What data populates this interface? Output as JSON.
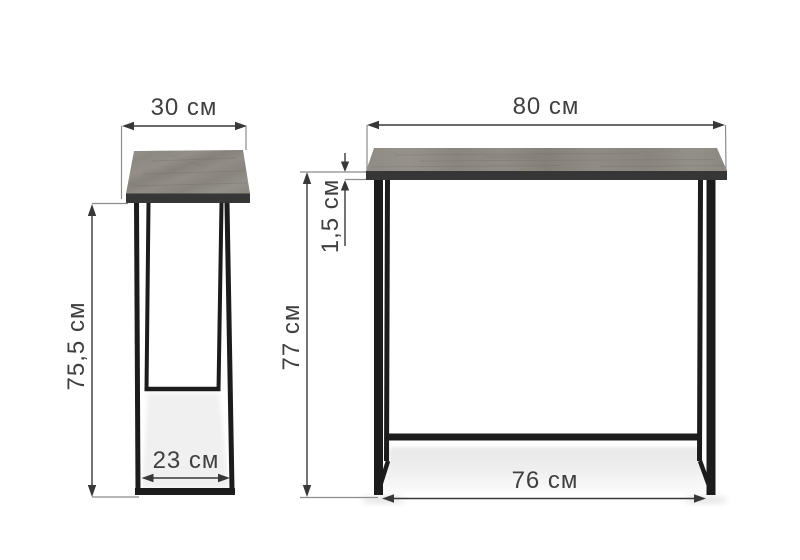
{
  "diagram": {
    "kind": "furniture-dimension-diagram",
    "unit": "см",
    "views": {
      "side": {
        "top_depth": "30 см",
        "frame_height": "75,5 см",
        "leg_span": "23 см"
      },
      "front": {
        "top_width": "80 см",
        "top_thickness": "1,5 см",
        "height": "77 см",
        "leg_span": "76 см"
      }
    },
    "colors": {
      "background": "#ffffff",
      "tabletop_wood": "#8e8a84",
      "tabletop_edge": "#363636",
      "metal_frame": "#1c1c1c",
      "dimension_line": "#383838",
      "extension_line": "#8c8c8c",
      "shadow": "#ededed"
    }
  }
}
